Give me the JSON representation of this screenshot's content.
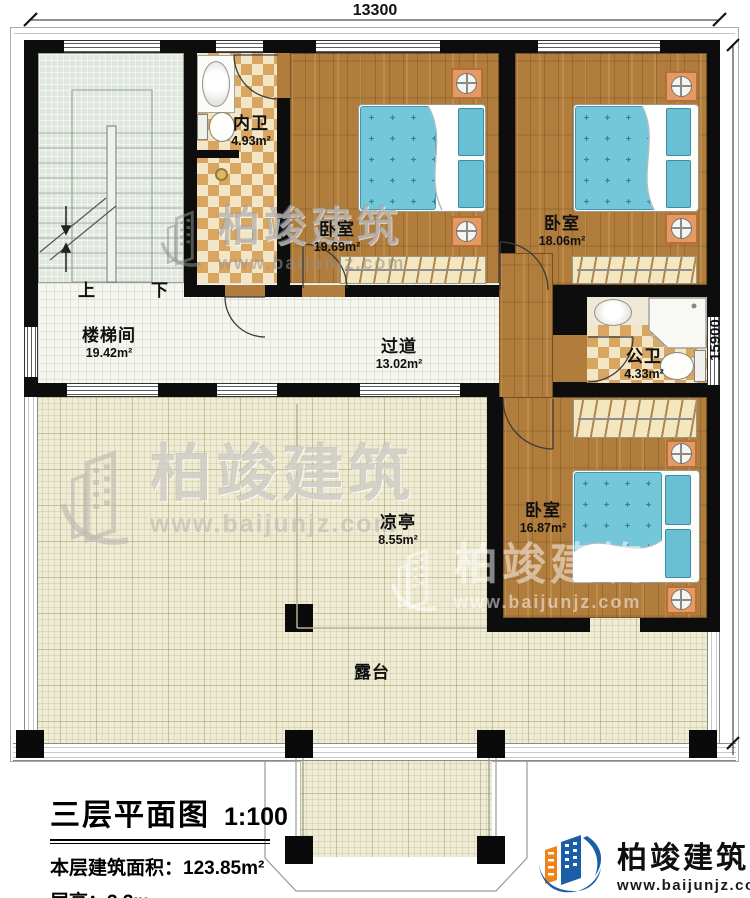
{
  "dimensions": {
    "width": "13300",
    "height": "15900"
  },
  "rooms": [
    {
      "name": "内卫",
      "area": "4.93m²"
    },
    {
      "name": "卧室",
      "area": "19.69m²"
    },
    {
      "name": "卧室",
      "area": "18.06m²"
    },
    {
      "name": "楼梯间",
      "area": "19.42m²"
    },
    {
      "name": "过道",
      "area": "13.02m²"
    },
    {
      "name": "公卫",
      "area": "4.33m²"
    },
    {
      "name": "凉亭",
      "area": "8.55m²"
    },
    {
      "name": "卧室",
      "area": "16.87m²"
    },
    {
      "name": "露台",
      "area": ""
    }
  ],
  "stairs": {
    "up": "上",
    "down": "下"
  },
  "title_block": {
    "title": "三层平面图",
    "scale": "1:100",
    "area_label": "本层建筑面积：",
    "area_value": "123.85m²",
    "height_label": "层高：",
    "height_value": "3.3m"
  },
  "brand": {
    "name": "柏竣建筑",
    "url": "www.baijunjz.com"
  },
  "watermark": {
    "name": "柏竣建筑",
    "url": "www.baijunjz.com"
  },
  "colors": {
    "wall": "#111111",
    "wood": "#b07c3c",
    "checker": "#d9a863",
    "bed": "#74c6d9",
    "stair": "#e0e7df",
    "terrace": "#efecd4",
    "brand_blue": "#1b5ea8",
    "brand_orange": "#f08419"
  }
}
